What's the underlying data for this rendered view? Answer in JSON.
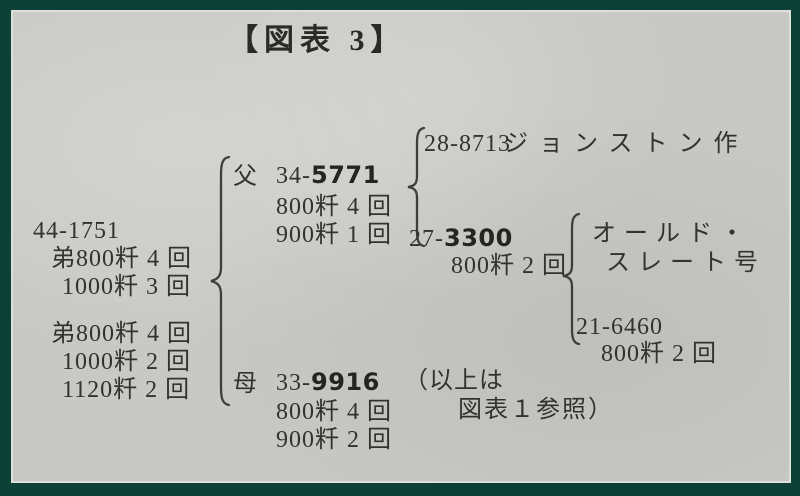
{
  "figure": {
    "title": "【図表 3】"
  },
  "colors": {
    "border": "#0d4137",
    "paper": "#c8c8c4",
    "ink": "#34322d"
  },
  "subject": {
    "id": "44-1751",
    "records": [
      "弟800粁 4 回",
      "1000粁 3 回",
      "弟800粁 4 回",
      "1000粁 2 回",
      "1120粁 2 回"
    ]
  },
  "father": {
    "label": "父",
    "id_prefix": "34-",
    "id_bold": "5771",
    "records": [
      "800粁 4 回",
      "900粁 1 回"
    ]
  },
  "mother": {
    "label": "母",
    "id_prefix": "33-",
    "id_bold": "9916",
    "note_open": "（以上は",
    "note_close": "図表１参照）",
    "records": [
      "800粁 4 回",
      "900粁 2 回"
    ]
  },
  "paternal_grandsire": {
    "id": "28-8713",
    "breeder": "ジョンストン作"
  },
  "paternal_granddam": {
    "id_prefix": "27-",
    "id_bold": "3300",
    "record": "800粁 2 回"
  },
  "great_grandsire": {
    "name_line1": "オールド・",
    "name_line2": "スレート号"
  },
  "great_granddam": {
    "id": "21-6460",
    "record": "800粁 2 回"
  }
}
